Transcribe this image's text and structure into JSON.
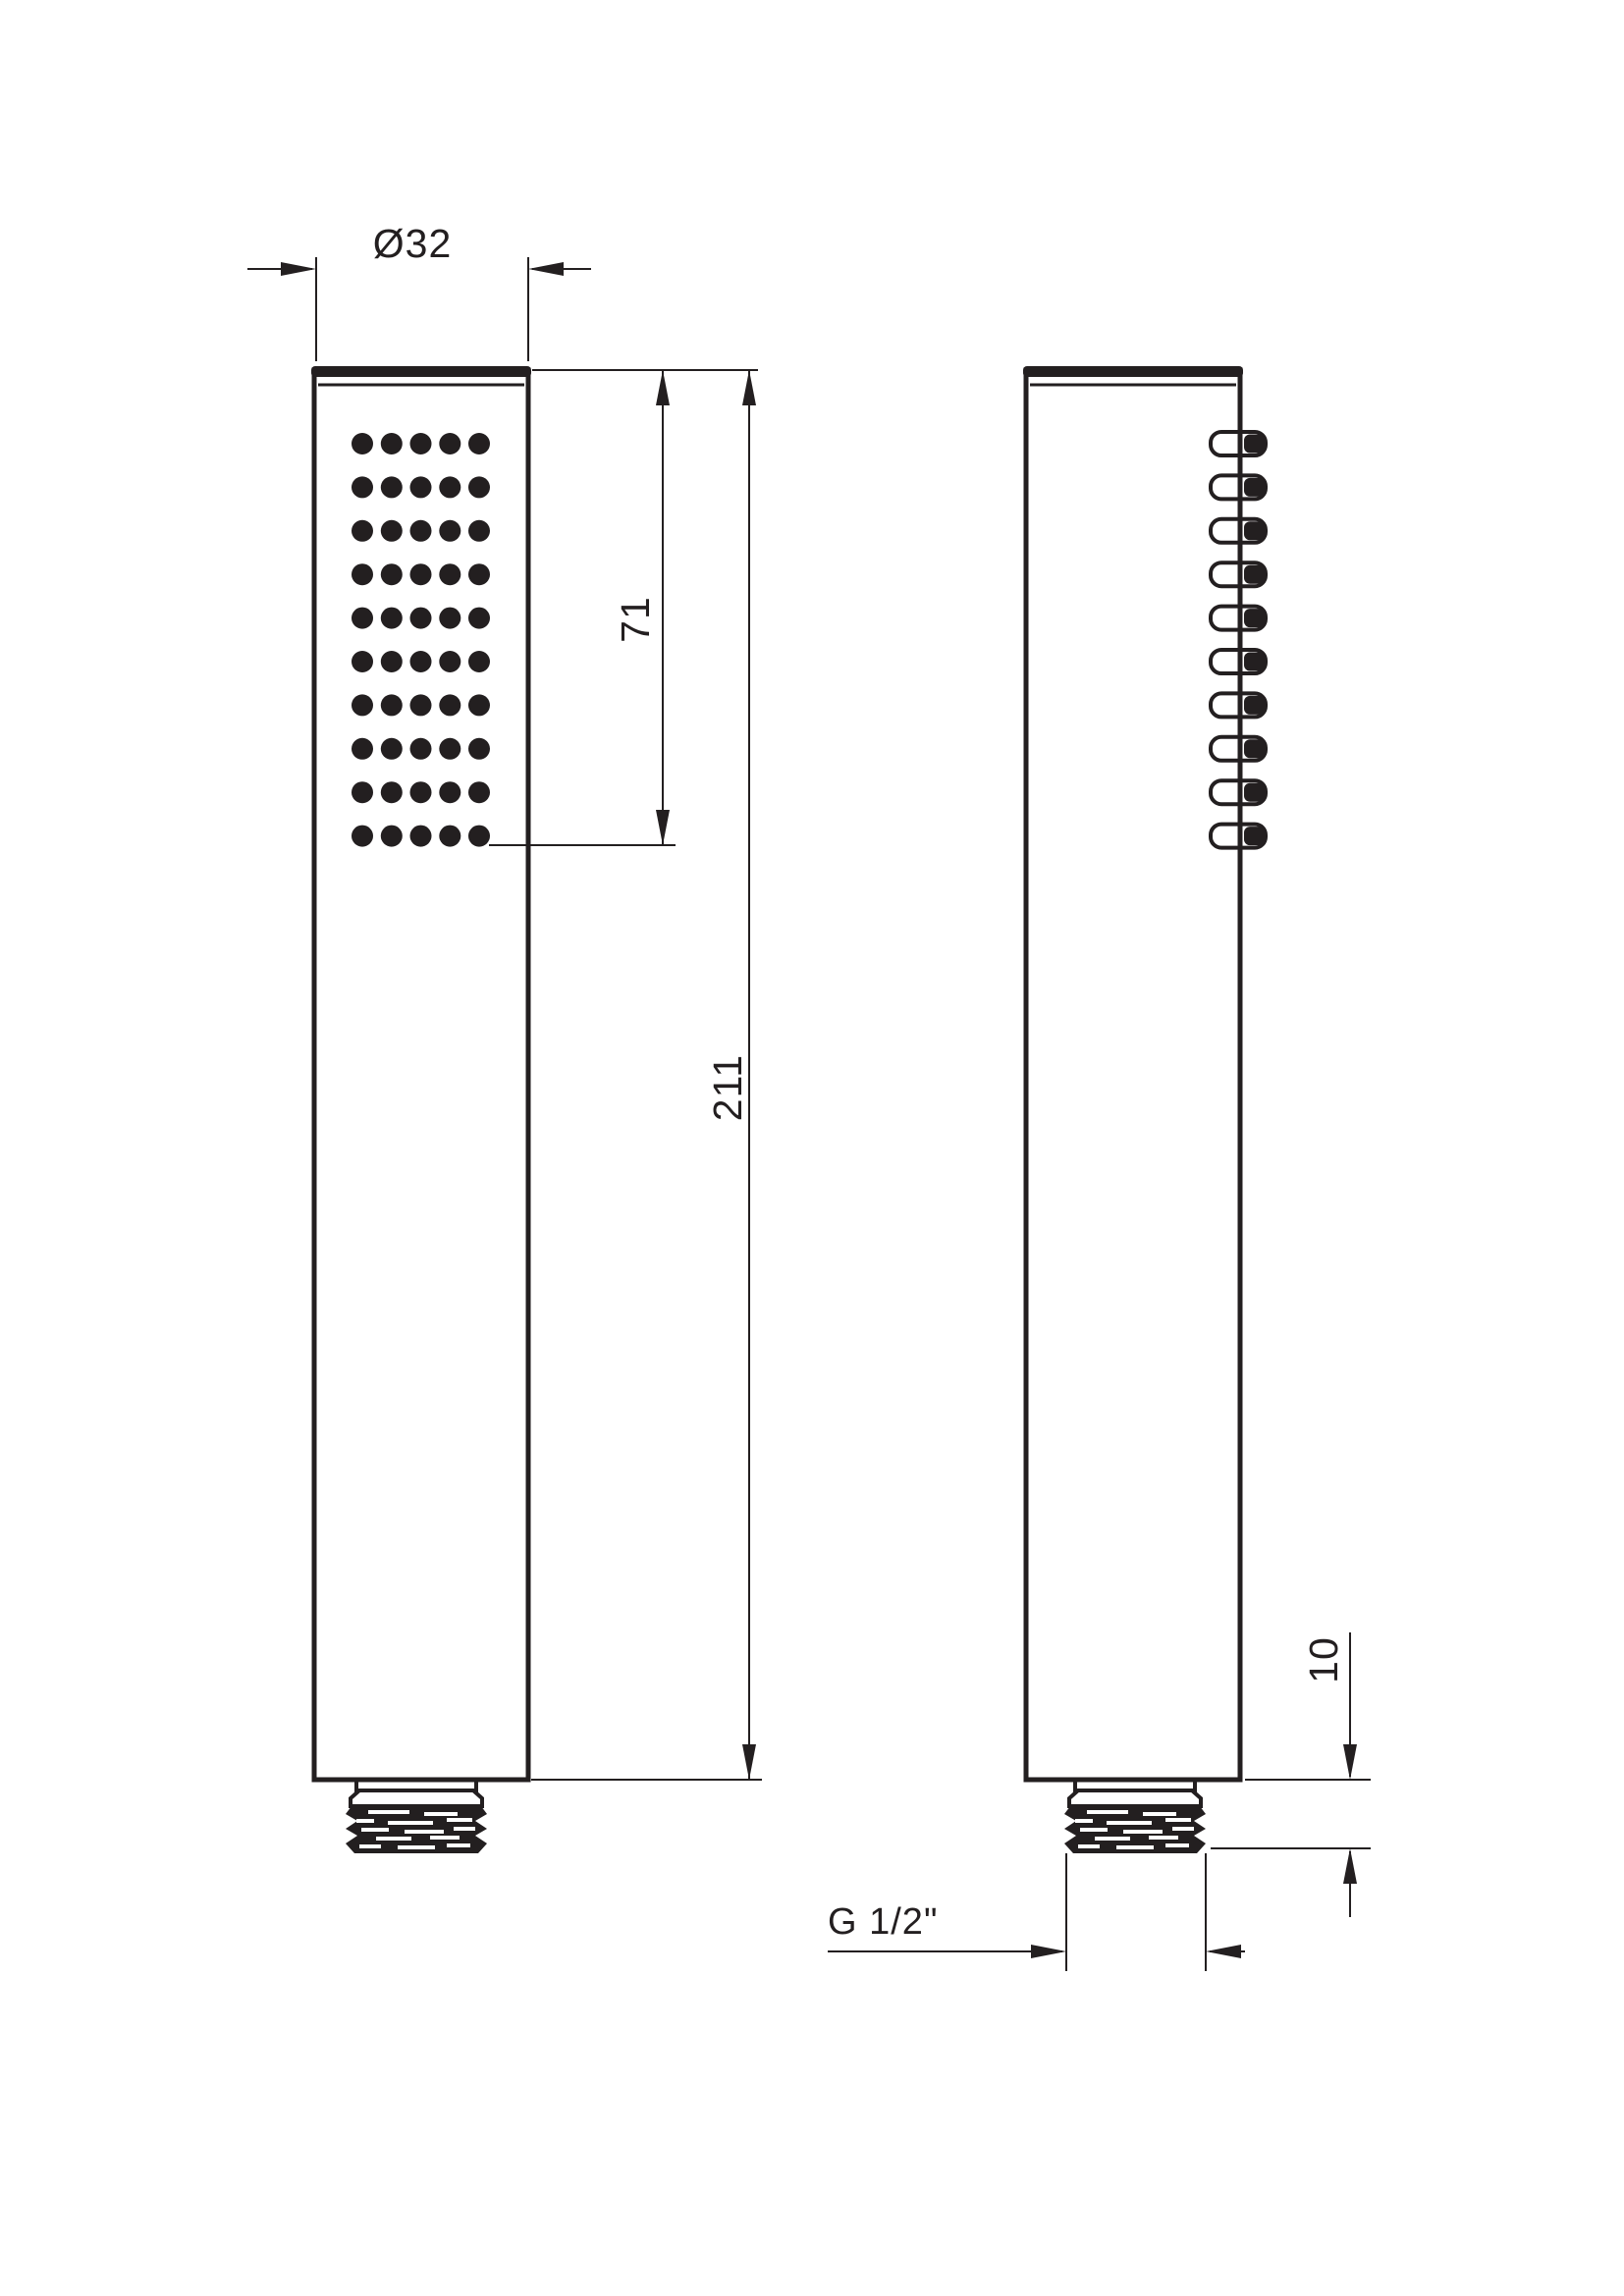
{
  "colors": {
    "line": "#231f20",
    "background": "#ffffff"
  },
  "labels": {
    "diameter_top": "Ø32",
    "spray_face_length": "71",
    "total_length": "211",
    "thread_length": "10",
    "thread_spec": "G 1/2\""
  },
  "views": {
    "front": {
      "spray_rows": 10,
      "spray_cols": 5
    },
    "side": {
      "nozzle_count": 10
    }
  }
}
